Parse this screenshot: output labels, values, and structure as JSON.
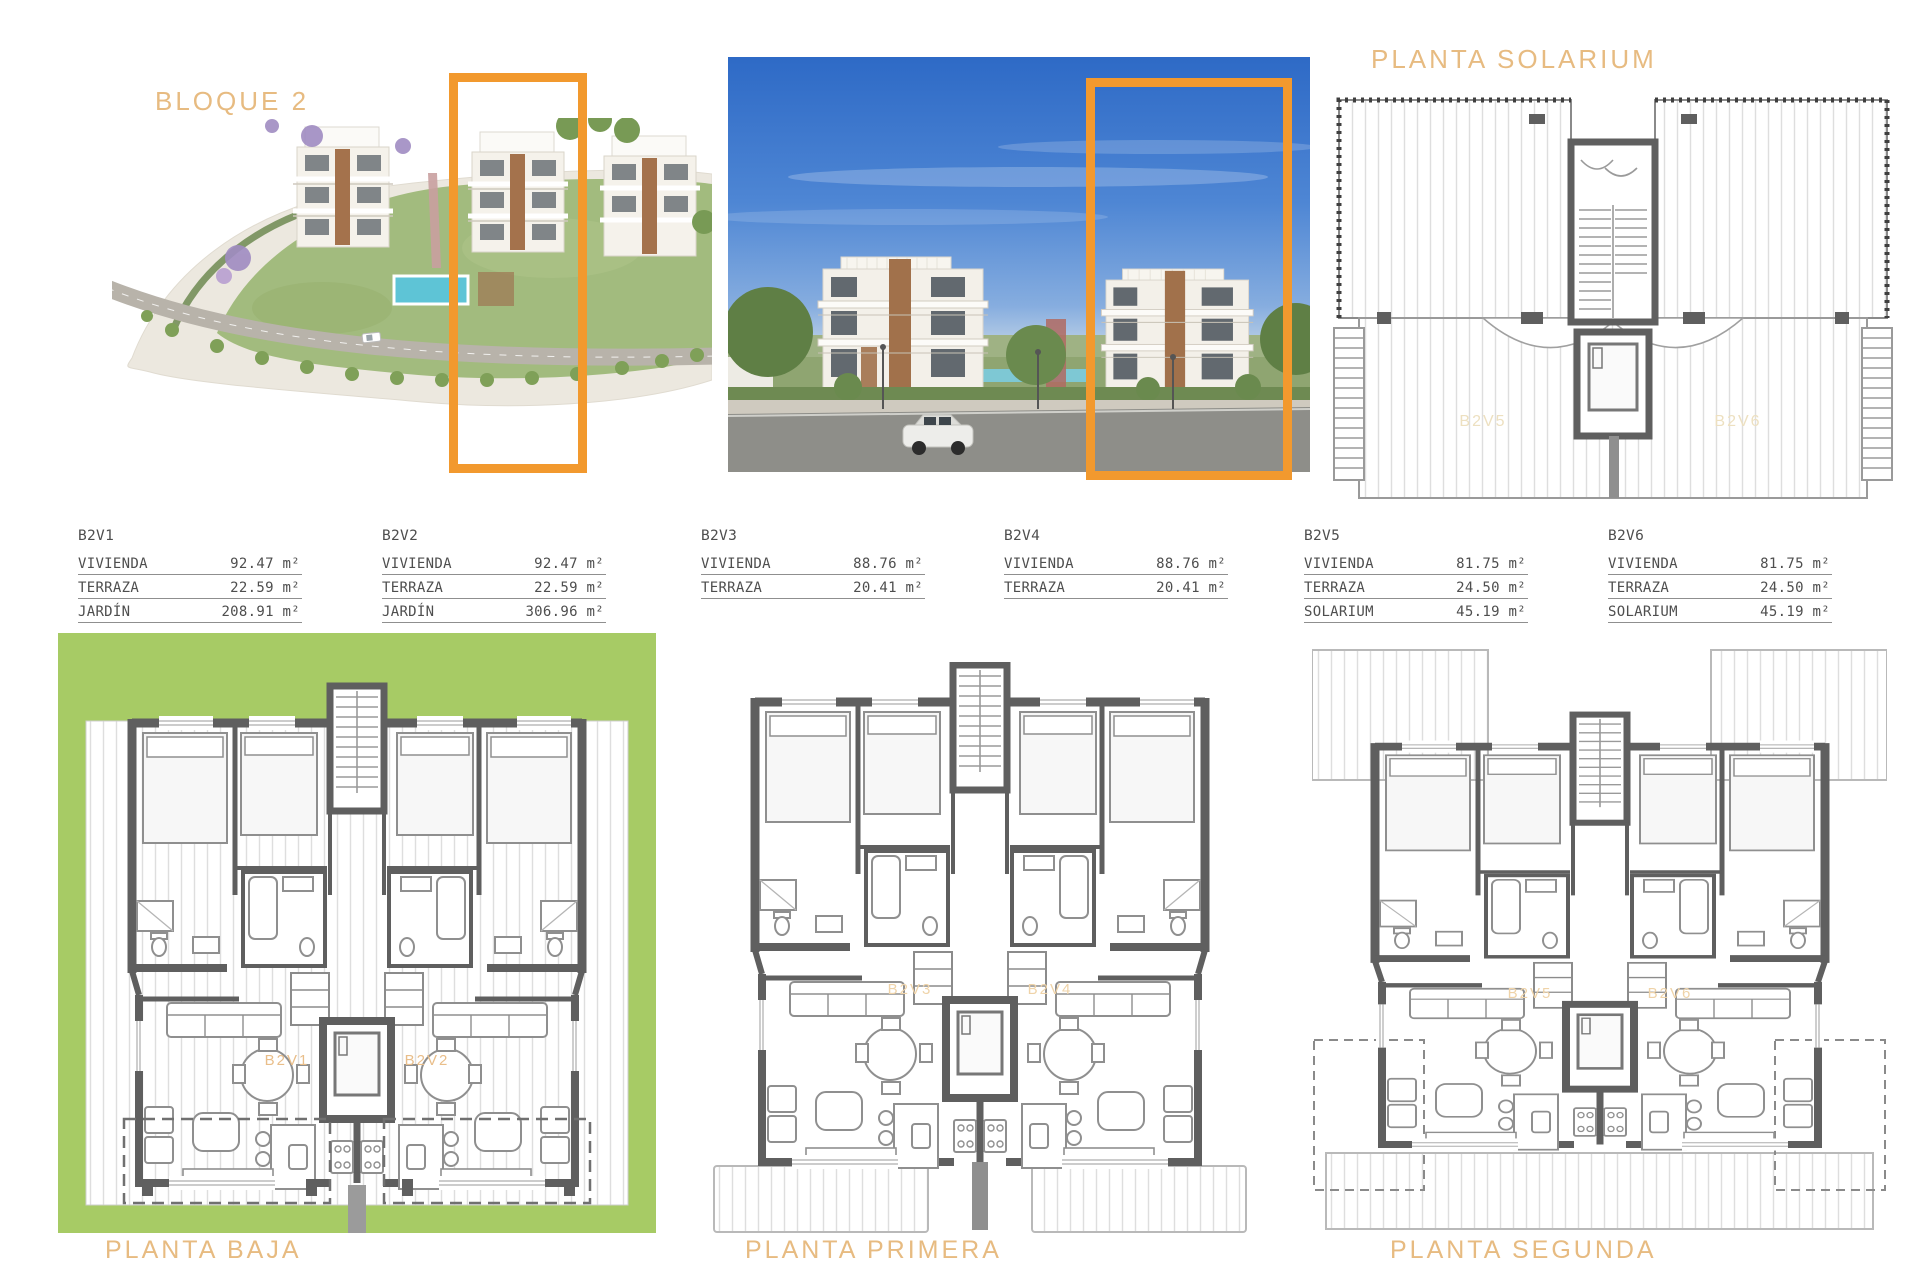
{
  "header": {
    "block_title": "BLOQUE 2",
    "solarium_title": "PLANTA SOLARIUM"
  },
  "colors": {
    "highlight_orange": "#F2992E",
    "title_orange": "#E7BB81",
    "plan_green": "#A7CB65",
    "wall_gray": "#5F5F5F"
  },
  "units": [
    {
      "name": "B2V1",
      "rows": [
        {
          "label": "VIVIENDA",
          "value": "92.47 m²"
        },
        {
          "label": "TERRAZA",
          "value": "22.59 m²"
        },
        {
          "label": "JARDÍN",
          "value": "208.91 m²"
        }
      ]
    },
    {
      "name": "B2V2",
      "rows": [
        {
          "label": "VIVIENDA",
          "value": "92.47 m²"
        },
        {
          "label": "TERRAZA",
          "value": "22.59 m²"
        },
        {
          "label": "JARDÍN",
          "value": "306.96 m²"
        }
      ]
    },
    {
      "name": "B2V3",
      "rows": [
        {
          "label": "VIVIENDA",
          "value": "88.76 m²"
        },
        {
          "label": "TERRAZA",
          "value": "20.41 m²"
        }
      ]
    },
    {
      "name": "B2V4",
      "rows": [
        {
          "label": "VIVIENDA",
          "value": "88.76 m²"
        },
        {
          "label": "TERRAZA",
          "value": "20.41 m²"
        }
      ]
    },
    {
      "name": "B2V5",
      "rows": [
        {
          "label": "VIVIENDA",
          "value": "81.75 m²"
        },
        {
          "label": "TERRAZA",
          "value": "24.50 m²"
        },
        {
          "label": "SOLARIUM",
          "value": "45.19 m²"
        }
      ]
    },
    {
      "name": "B2V6",
      "rows": [
        {
          "label": "VIVIENDA",
          "value": "81.75 m²"
        },
        {
          "label": "TERRAZA",
          "value": "24.50 m²"
        },
        {
          "label": "SOLARIUM",
          "value": "45.19 m²"
        }
      ]
    }
  ],
  "plans": {
    "baja": {
      "title": "PLANTA BAJA",
      "unit_left": "B2V1",
      "unit_right": "B2V2"
    },
    "primera": {
      "title": "PLANTA PRIMERA",
      "unit_left": "B2V3",
      "unit_right": "B2V4"
    },
    "segunda": {
      "title": "PLANTA SEGUNDA",
      "unit_left": "B2V5",
      "unit_right": "B2V6"
    },
    "solarium": {
      "unit_left": "B2V5",
      "unit_right": "B2V6"
    }
  }
}
